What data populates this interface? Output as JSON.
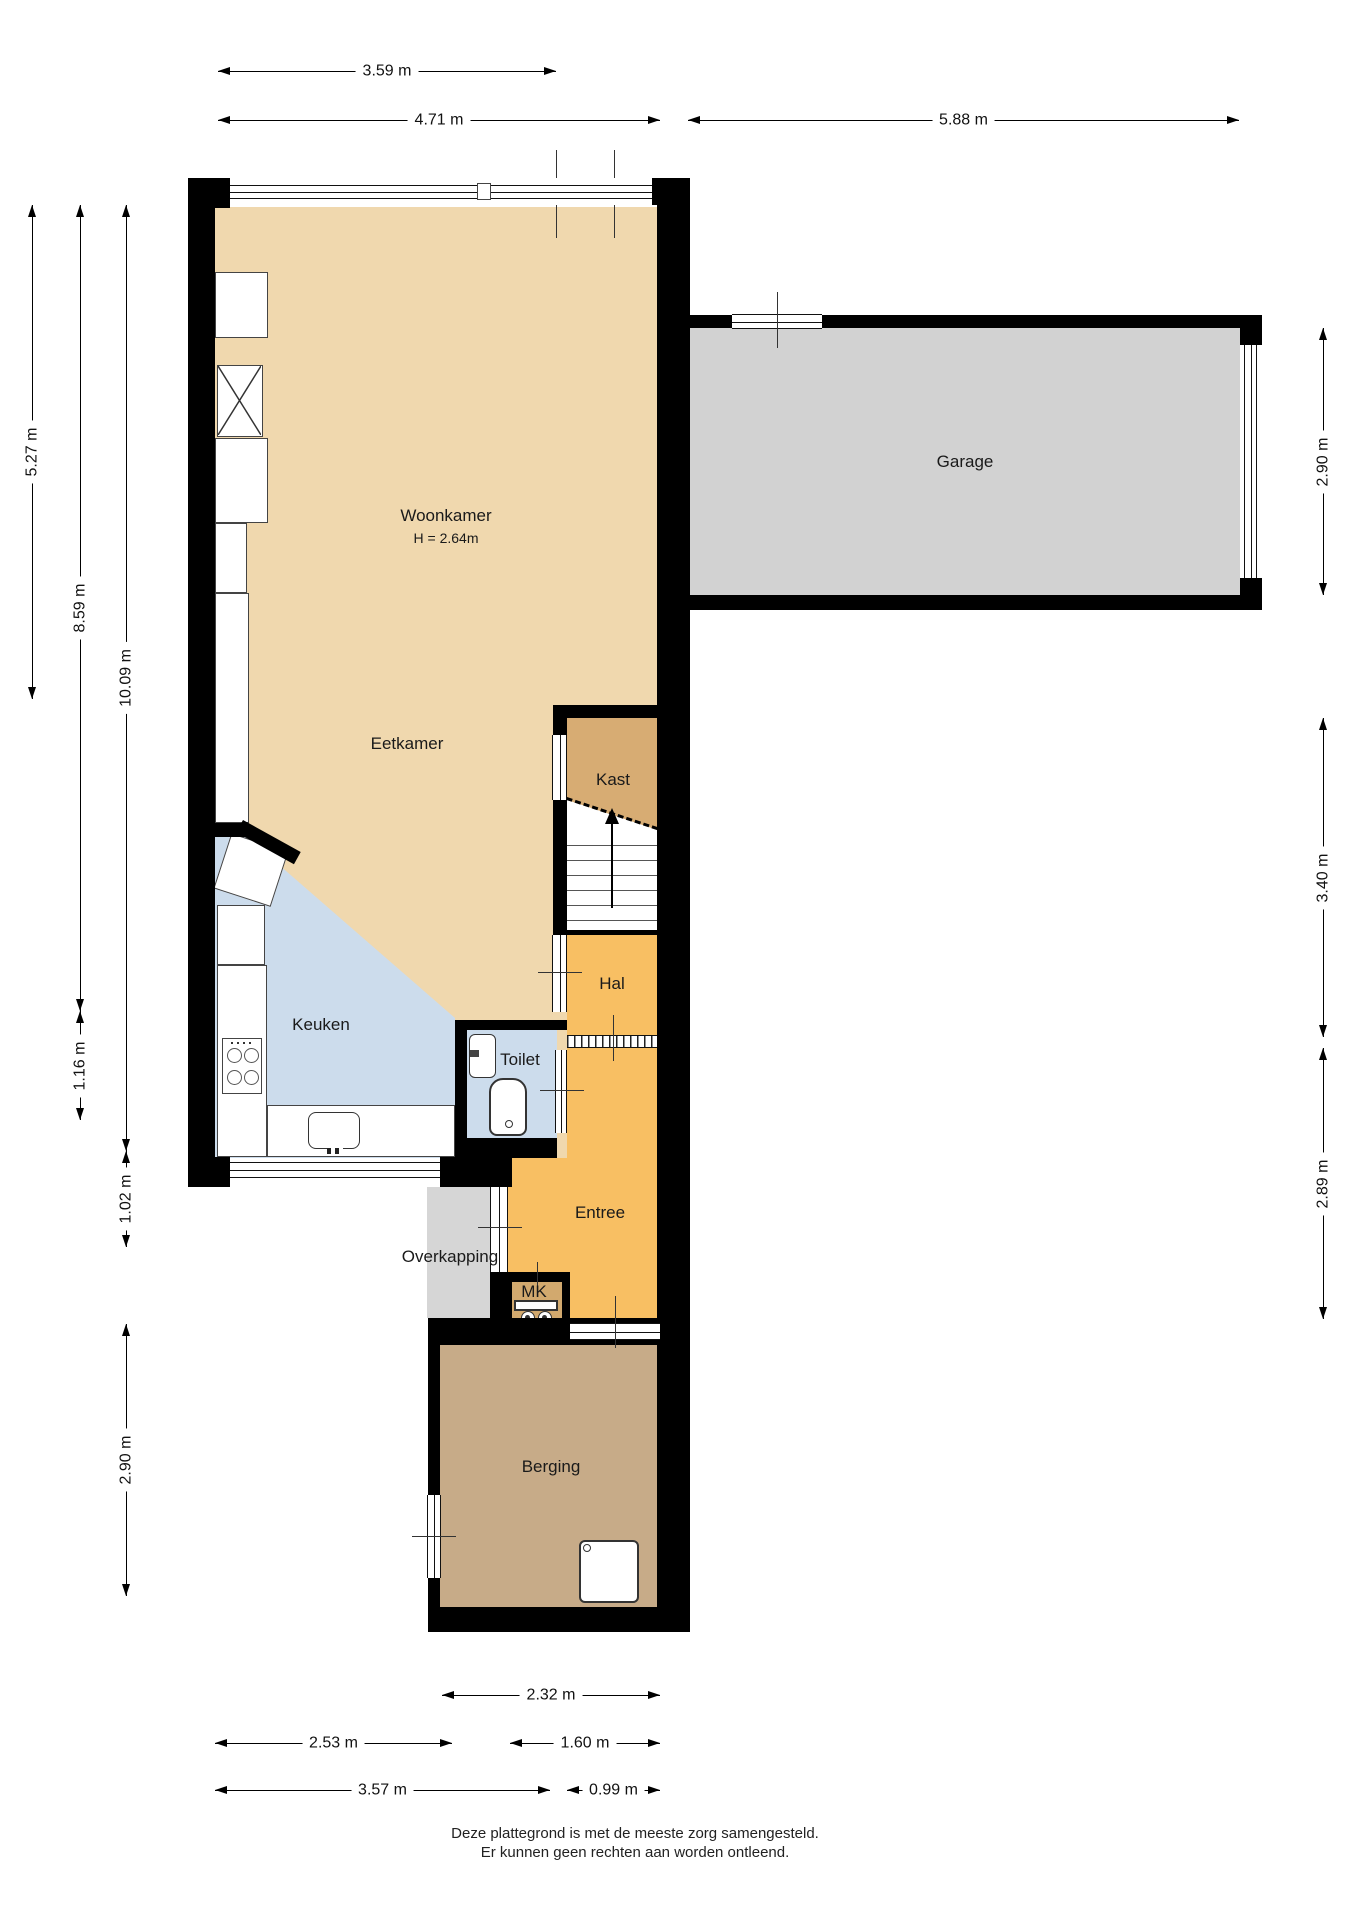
{
  "title": "Begane grond plattegrond",
  "rooms": {
    "woonkamer": {
      "label": "Woonkamer",
      "height_note": "H = 2.64m"
    },
    "eetkamer": {
      "label": "Eetkamer"
    },
    "garage": {
      "label": "Garage"
    },
    "kast": {
      "label": "Kast"
    },
    "hal": {
      "label": "Hal"
    },
    "keuken": {
      "label": "Keuken"
    },
    "toilet": {
      "label": "Toilet"
    },
    "entree": {
      "label": "Entree"
    },
    "overkapping": {
      "label": "Overkapping"
    },
    "mk": {
      "label": "MK"
    },
    "berging": {
      "label": "Berging"
    }
  },
  "dims": {
    "t1": "3.59 m",
    "t2": "4.71 m",
    "t3": "5.88 m",
    "l1": "5.27 m",
    "l2": "8.59 m",
    "l3": "10.09 m",
    "l4": "1.16 m",
    "l5": "1.02 m",
    "l6": "2.90 m",
    "r1": "2.90 m",
    "r2": "3.40 m",
    "r3": "2.89 m",
    "b1": "2.32 m",
    "b2": "2.53 m",
    "b3": "1.60 m",
    "b4": "3.57 m",
    "b5": "0.99 m"
  },
  "footer": {
    "line1": "Deze plattegrond is met de meeste zorg samengesteld.",
    "line2": "Er kunnen geen rechten aan worden ontleend."
  },
  "colors": {
    "wall": "#000000",
    "living_floor": "#F0D8AE",
    "kitchen_floor": "#CCDCEC",
    "hall_floor": "#F8BF63",
    "closet_floor": "#D7AC73",
    "storage_floor": "#C7AB88",
    "garage_floor": "#D2D2D2",
    "canopy_floor": "#D6D6D6",
    "mk_floor": "#D2A96E"
  }
}
